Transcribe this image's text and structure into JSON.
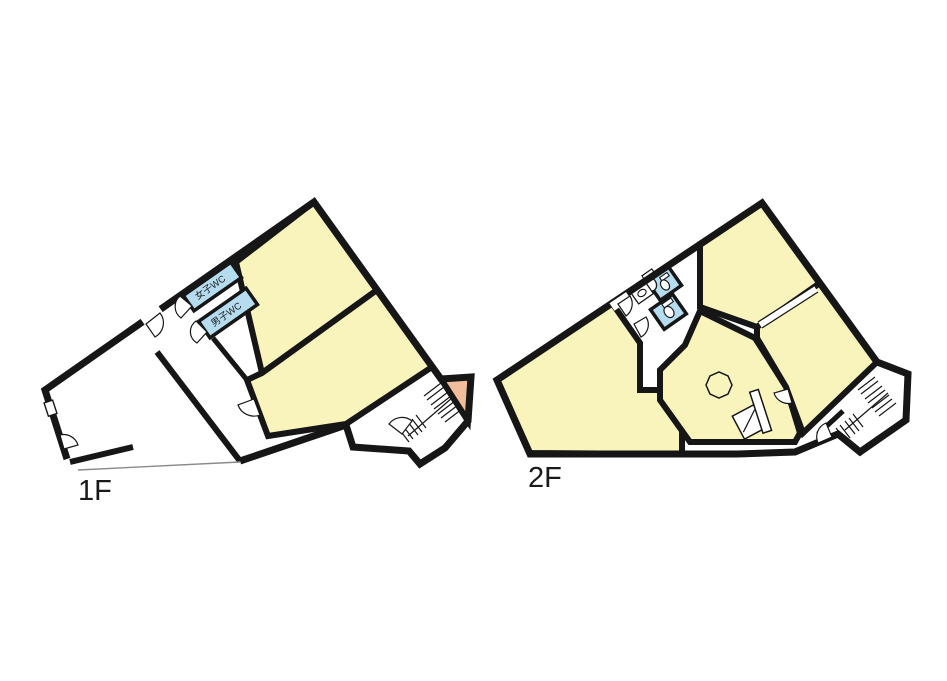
{
  "document": {
    "type": "building-floor-plan",
    "background": "#ffffff"
  },
  "floors": [
    {
      "id": "1F",
      "label": "1F",
      "wc_labels": [
        "女子WC",
        "男子WC"
      ]
    },
    {
      "id": "2F",
      "label": "2F"
    }
  ],
  "colors": {
    "room_fill": "#F9F4BC",
    "wc_fill": "#B5DCEF",
    "stair_landing_fill": "#F1BD9B",
    "wall": "#161616",
    "boundary_line": "#8a8a8a",
    "background": "#ffffff",
    "label_text": "#1a1a1a"
  },
  "icons": [
    "stairs-icon",
    "door-swing-icon",
    "toilet-icon",
    "urinal-icon",
    "sink-icon",
    "octagon-table",
    "cabinet",
    "counter-opening"
  ]
}
